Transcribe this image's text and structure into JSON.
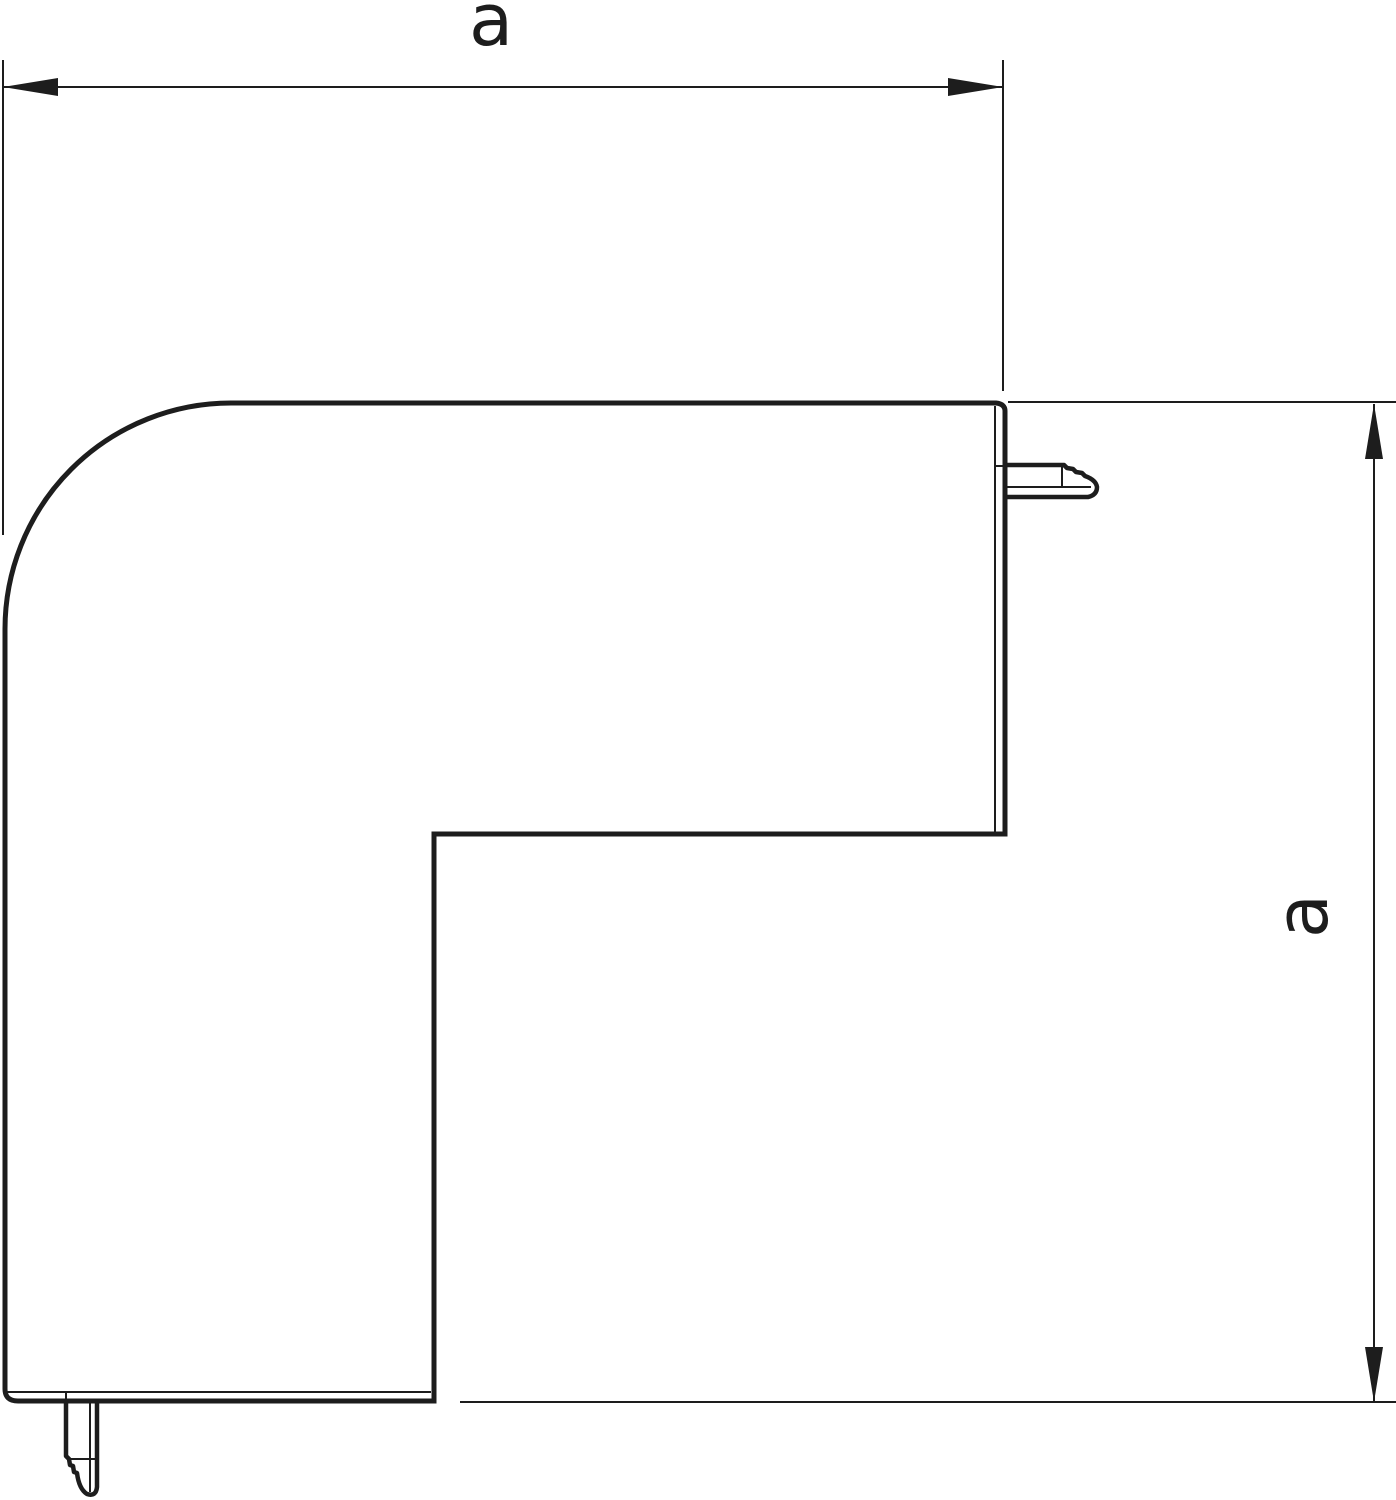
{
  "drawing": {
    "dimension_labels": {
      "horizontal": "a",
      "vertical": "a"
    },
    "line_color": "#1d1d1d",
    "background_color": "#ffffff"
  }
}
